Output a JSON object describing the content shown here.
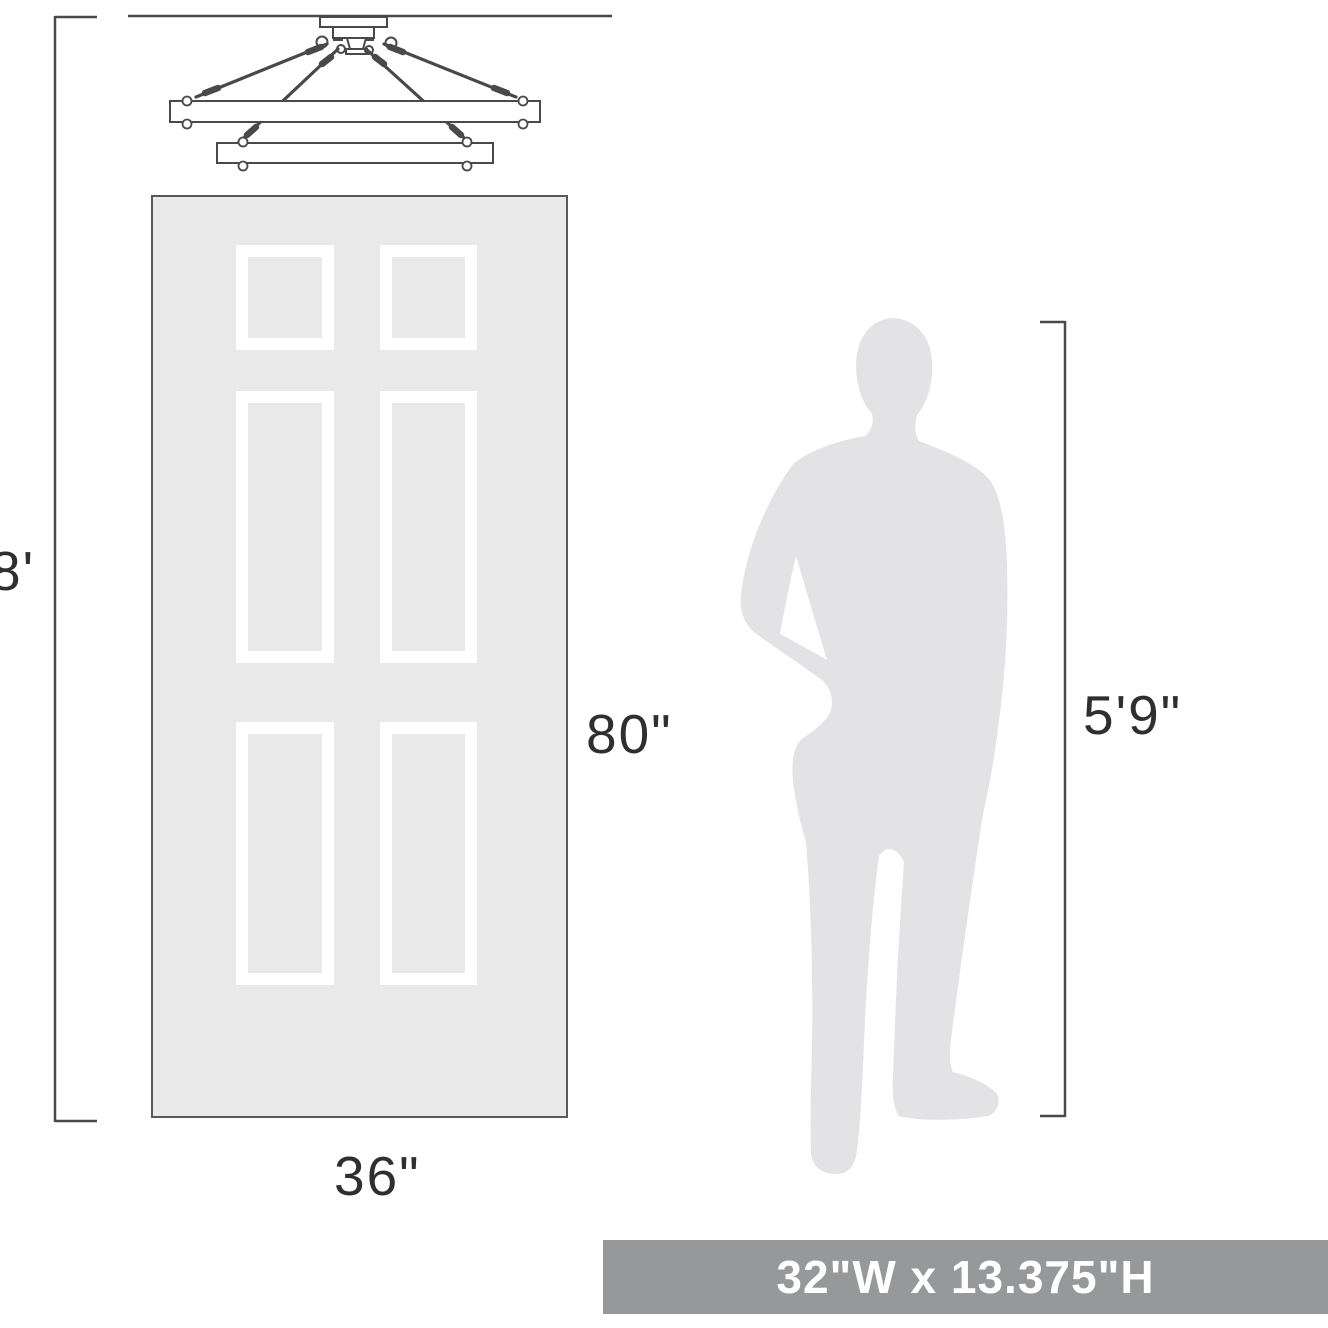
{
  "page": {
    "width": 1328,
    "height": 1328,
    "background": "#ffffff"
  },
  "labels": {
    "ceiling_height": "8'",
    "door_height": "80\"",
    "door_width": "36\"",
    "person_height": "5'9\""
  },
  "banner": {
    "text": "32\"W x 13.375\"H"
  },
  "figures": {
    "chandelier": "two-tier rectangular chandelier flush-mount line drawing",
    "door": "six-panel door outline",
    "person": "standing man silhouette"
  },
  "colors": {
    "line_art": "#48494b",
    "label_text": "#2f2f30",
    "door_fill": "#e9e9ea",
    "door_border": "#58595b",
    "panel_frame": "#ffffff",
    "person_fill": "#e3e3e5",
    "banner_background": "#97989a",
    "banner_text": "#ffffff"
  }
}
